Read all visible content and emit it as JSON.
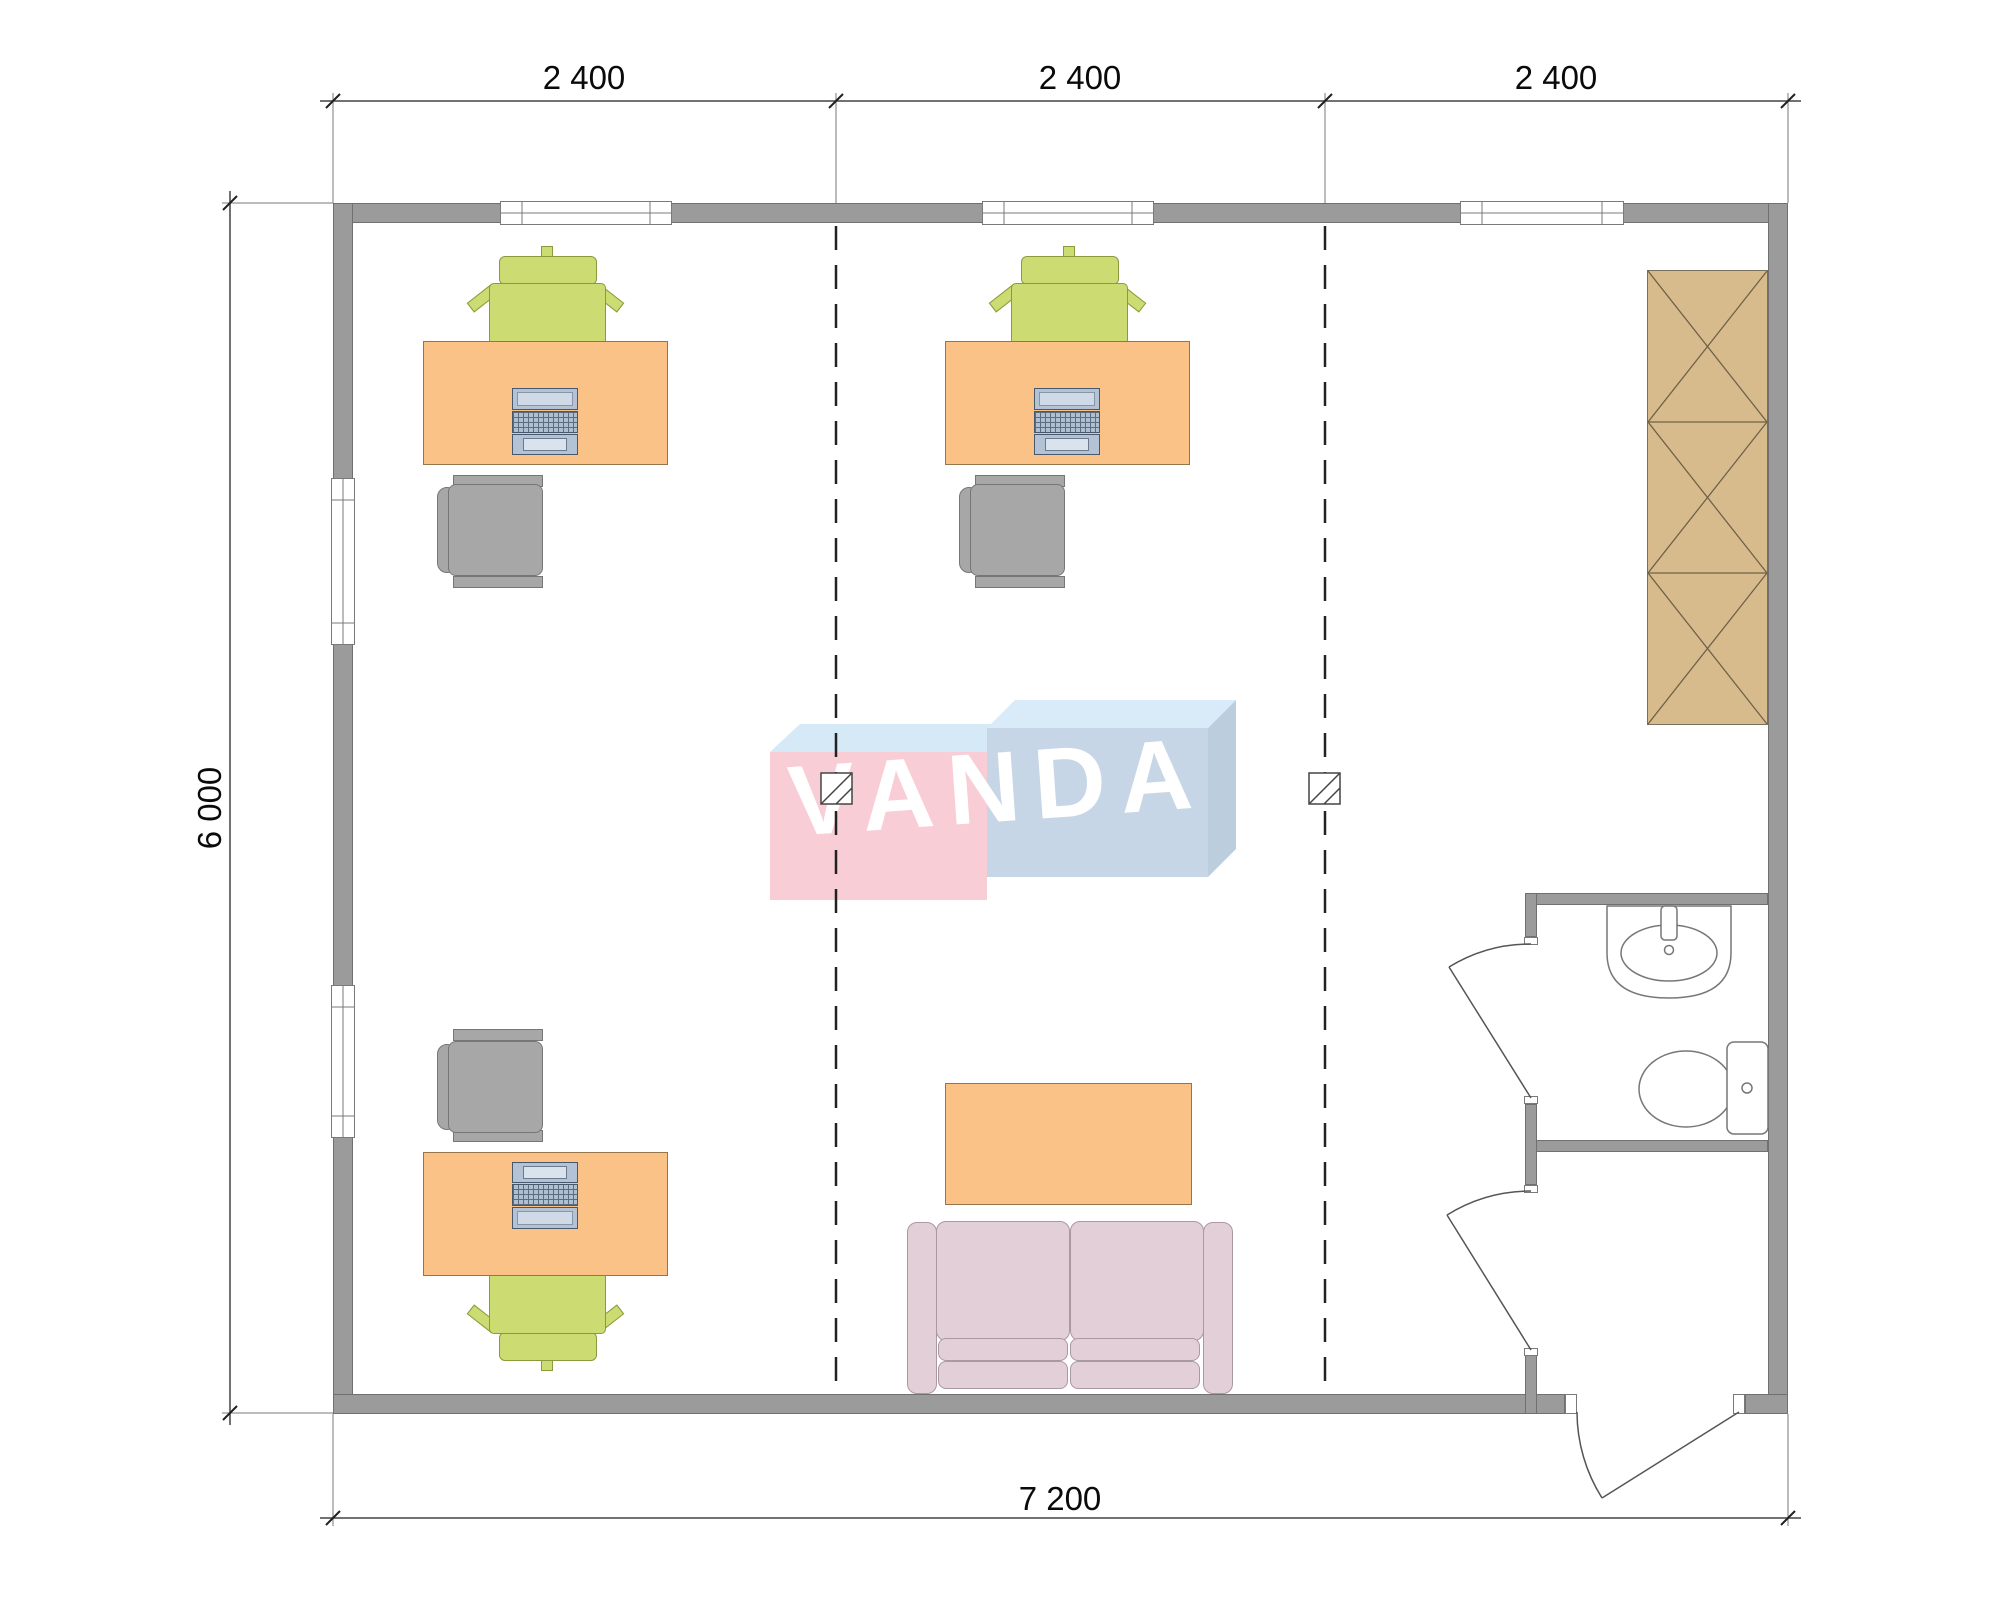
{
  "drawing": {
    "type": "floor-plan",
    "watermark": {
      "text": "VANDA",
      "text_color": "#ffffff",
      "box_pink": "#f8cdd6",
      "box_blue_front": "#c7d6e6",
      "flap_blue_light": "#d9ebf8",
      "flap_blue_side": "#bccede"
    },
    "dimensions": {
      "top_segments": [
        "2 400",
        "2 400",
        "2 400"
      ],
      "left_total": "6 000",
      "bottom_total": "7 200"
    },
    "colors": {
      "wall": "#9b9b9b",
      "desk": "#fbc287",
      "chair_green": "#ccdc72",
      "chair_gray": "#a7a7a7",
      "wardrobe": "#d8bb8d",
      "sofa": "#e2cfd7",
      "laptop": "#b3c2d5",
      "axis_dashed_line": "#222222"
    }
  }
}
